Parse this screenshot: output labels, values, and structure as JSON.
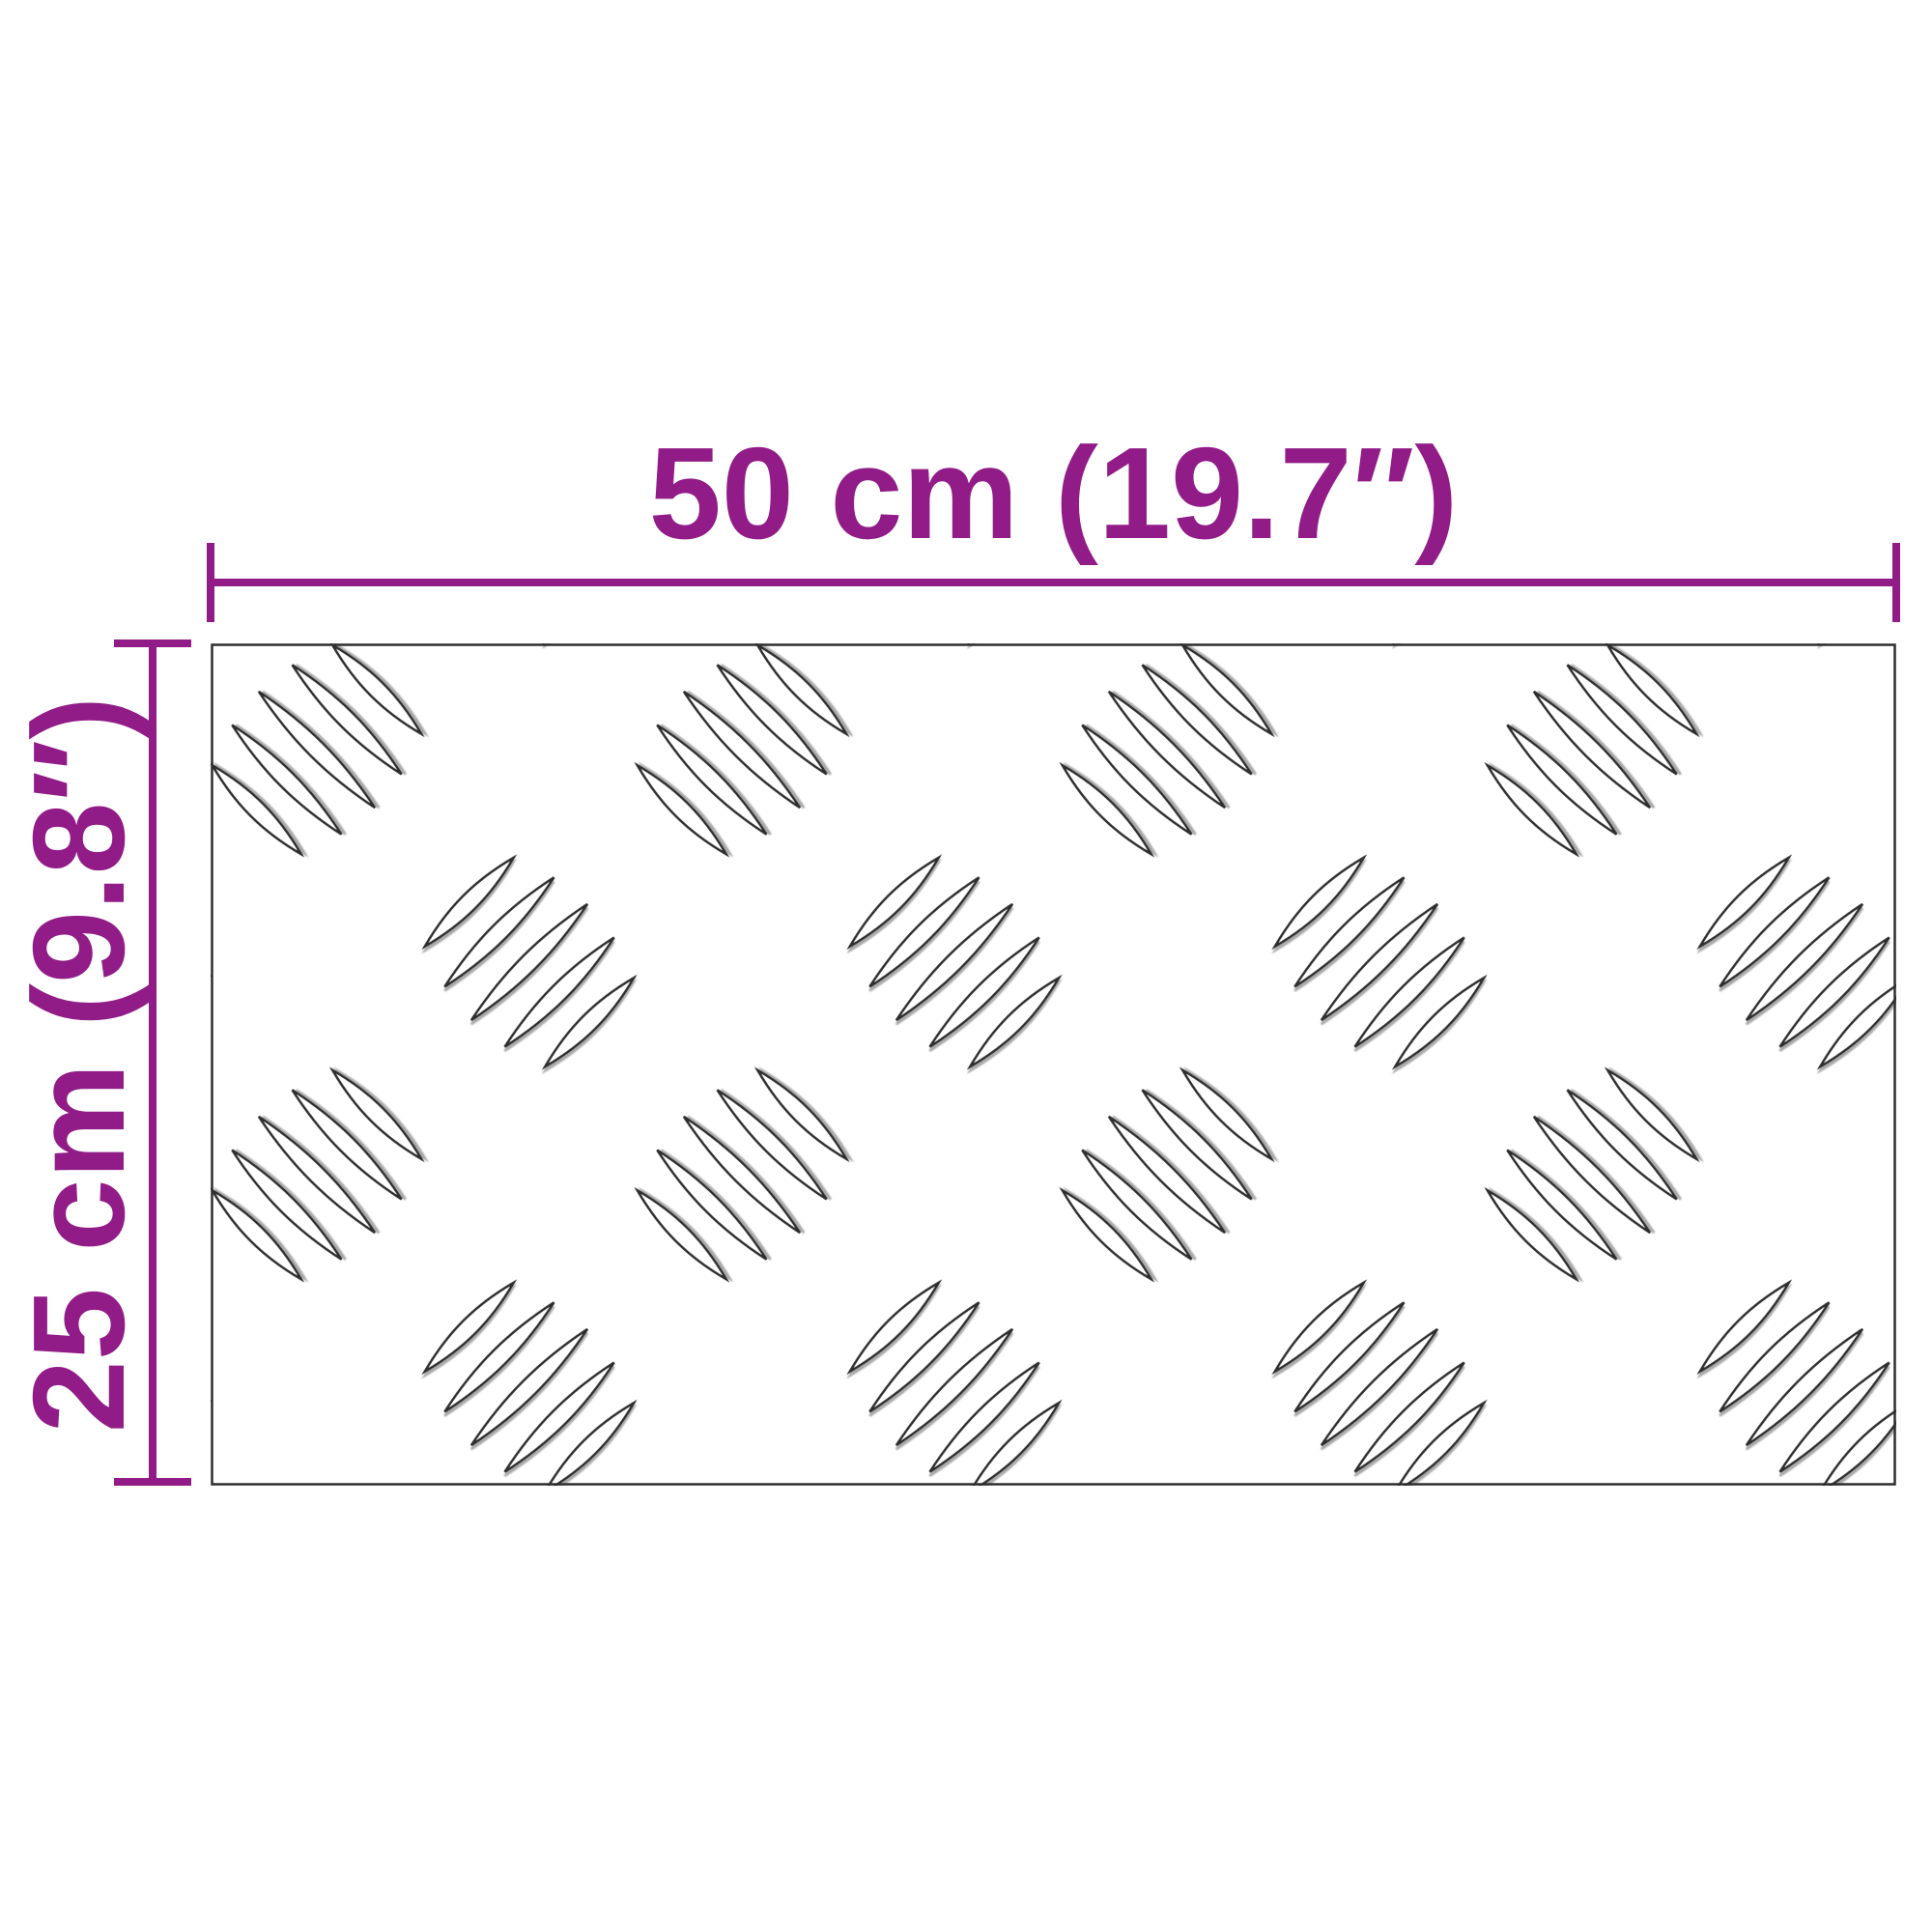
{
  "diagram": {
    "type": "product-dimension-diagram",
    "subject": "aluminium checker tread plate sheet",
    "background_color": "#ffffff",
    "accent_color": "#911c88",
    "plate_outline_color": "#2e2e2e",
    "pattern": "five-bar tread pattern, leaf clusters alternating +45/-45 degrees",
    "dimensions": {
      "width": {
        "label": "50 cm (19.7″)",
        "value_cm": 50,
        "value_inch": 19.7
      },
      "height": {
        "label": "25 cm (9.8″)",
        "value_cm": 25,
        "value_inch": 9.8
      }
    }
  }
}
